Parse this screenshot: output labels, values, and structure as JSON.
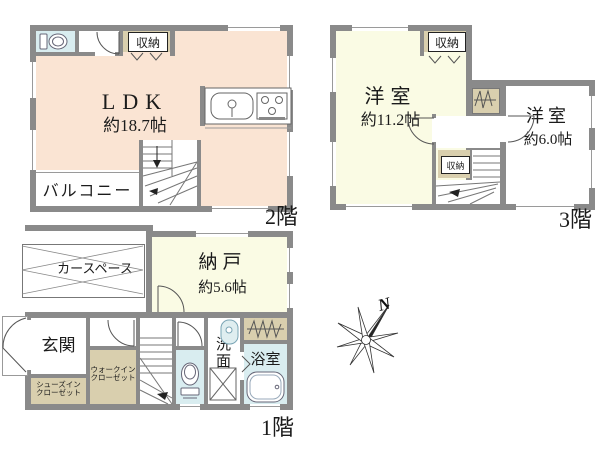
{
  "colors": {
    "wall": "#8a8a8a",
    "ldk": "#fae4d3",
    "yellow": "#fafbe4",
    "tan": "#d9cfae",
    "blue": "#d9edf0"
  },
  "floor2": {
    "label": "2階",
    "storage": "収納",
    "ldk_name": "LDK",
    "ldk_size": "約18.7帖",
    "balcony": "バルコニー"
  },
  "floor3": {
    "label": "3階",
    "storage_top": "収納",
    "storage_mid": "収納",
    "large_room": "洋室",
    "large_size": "約11.2帖",
    "small_room": "洋室",
    "small_size": "約6.0帖"
  },
  "floor1": {
    "label": "1階",
    "car_space": "カースペース",
    "nando_name": "納戸",
    "nando_size": "約5.6帖",
    "entrance": "玄関",
    "shoes_closet": "シューズイン\nクローゼット",
    "walkin_closet": "ウォークイン\nクローゼット",
    "washroom": "洗面所",
    "bathroom": "浴室"
  },
  "compass": {
    "north": "N"
  }
}
